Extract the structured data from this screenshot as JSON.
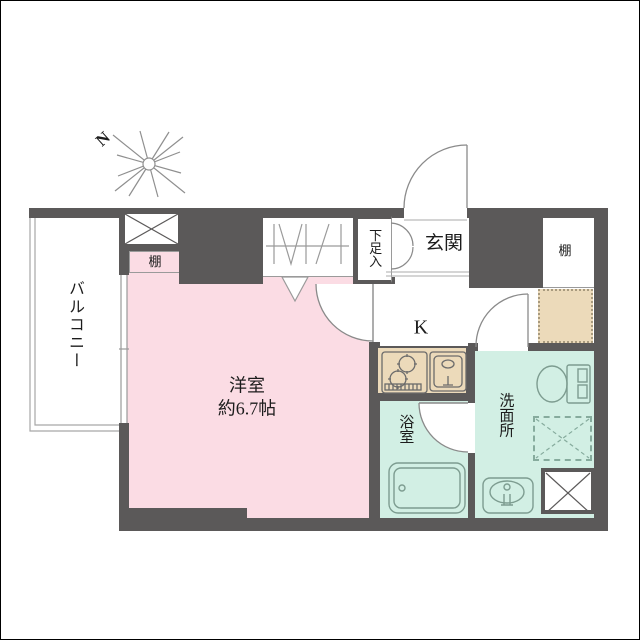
{
  "floorplan": {
    "compass": {
      "label": "N"
    },
    "balcony": {
      "label": "バルコニー"
    },
    "main_room": {
      "name": "洋室",
      "size": "約6.7帖"
    },
    "kitchen": {
      "label": "K"
    },
    "bathroom": {
      "label": "浴室"
    },
    "washroom": {
      "label": "洗面所"
    },
    "entrance": {
      "label": "玄関"
    },
    "shoe_storage": {
      "label": "下足入"
    },
    "shelf_left": {
      "label": "棚"
    },
    "shelf_right": {
      "label": "棚"
    },
    "colors": {
      "wall": "#5b5959",
      "room_pink": "#fbdce4",
      "wet_mint": "#d2efe4",
      "counter_beige": "#ecdaba",
      "fixture_line": "#7d9c90",
      "thin_line": "#9a9a9a"
    }
  }
}
